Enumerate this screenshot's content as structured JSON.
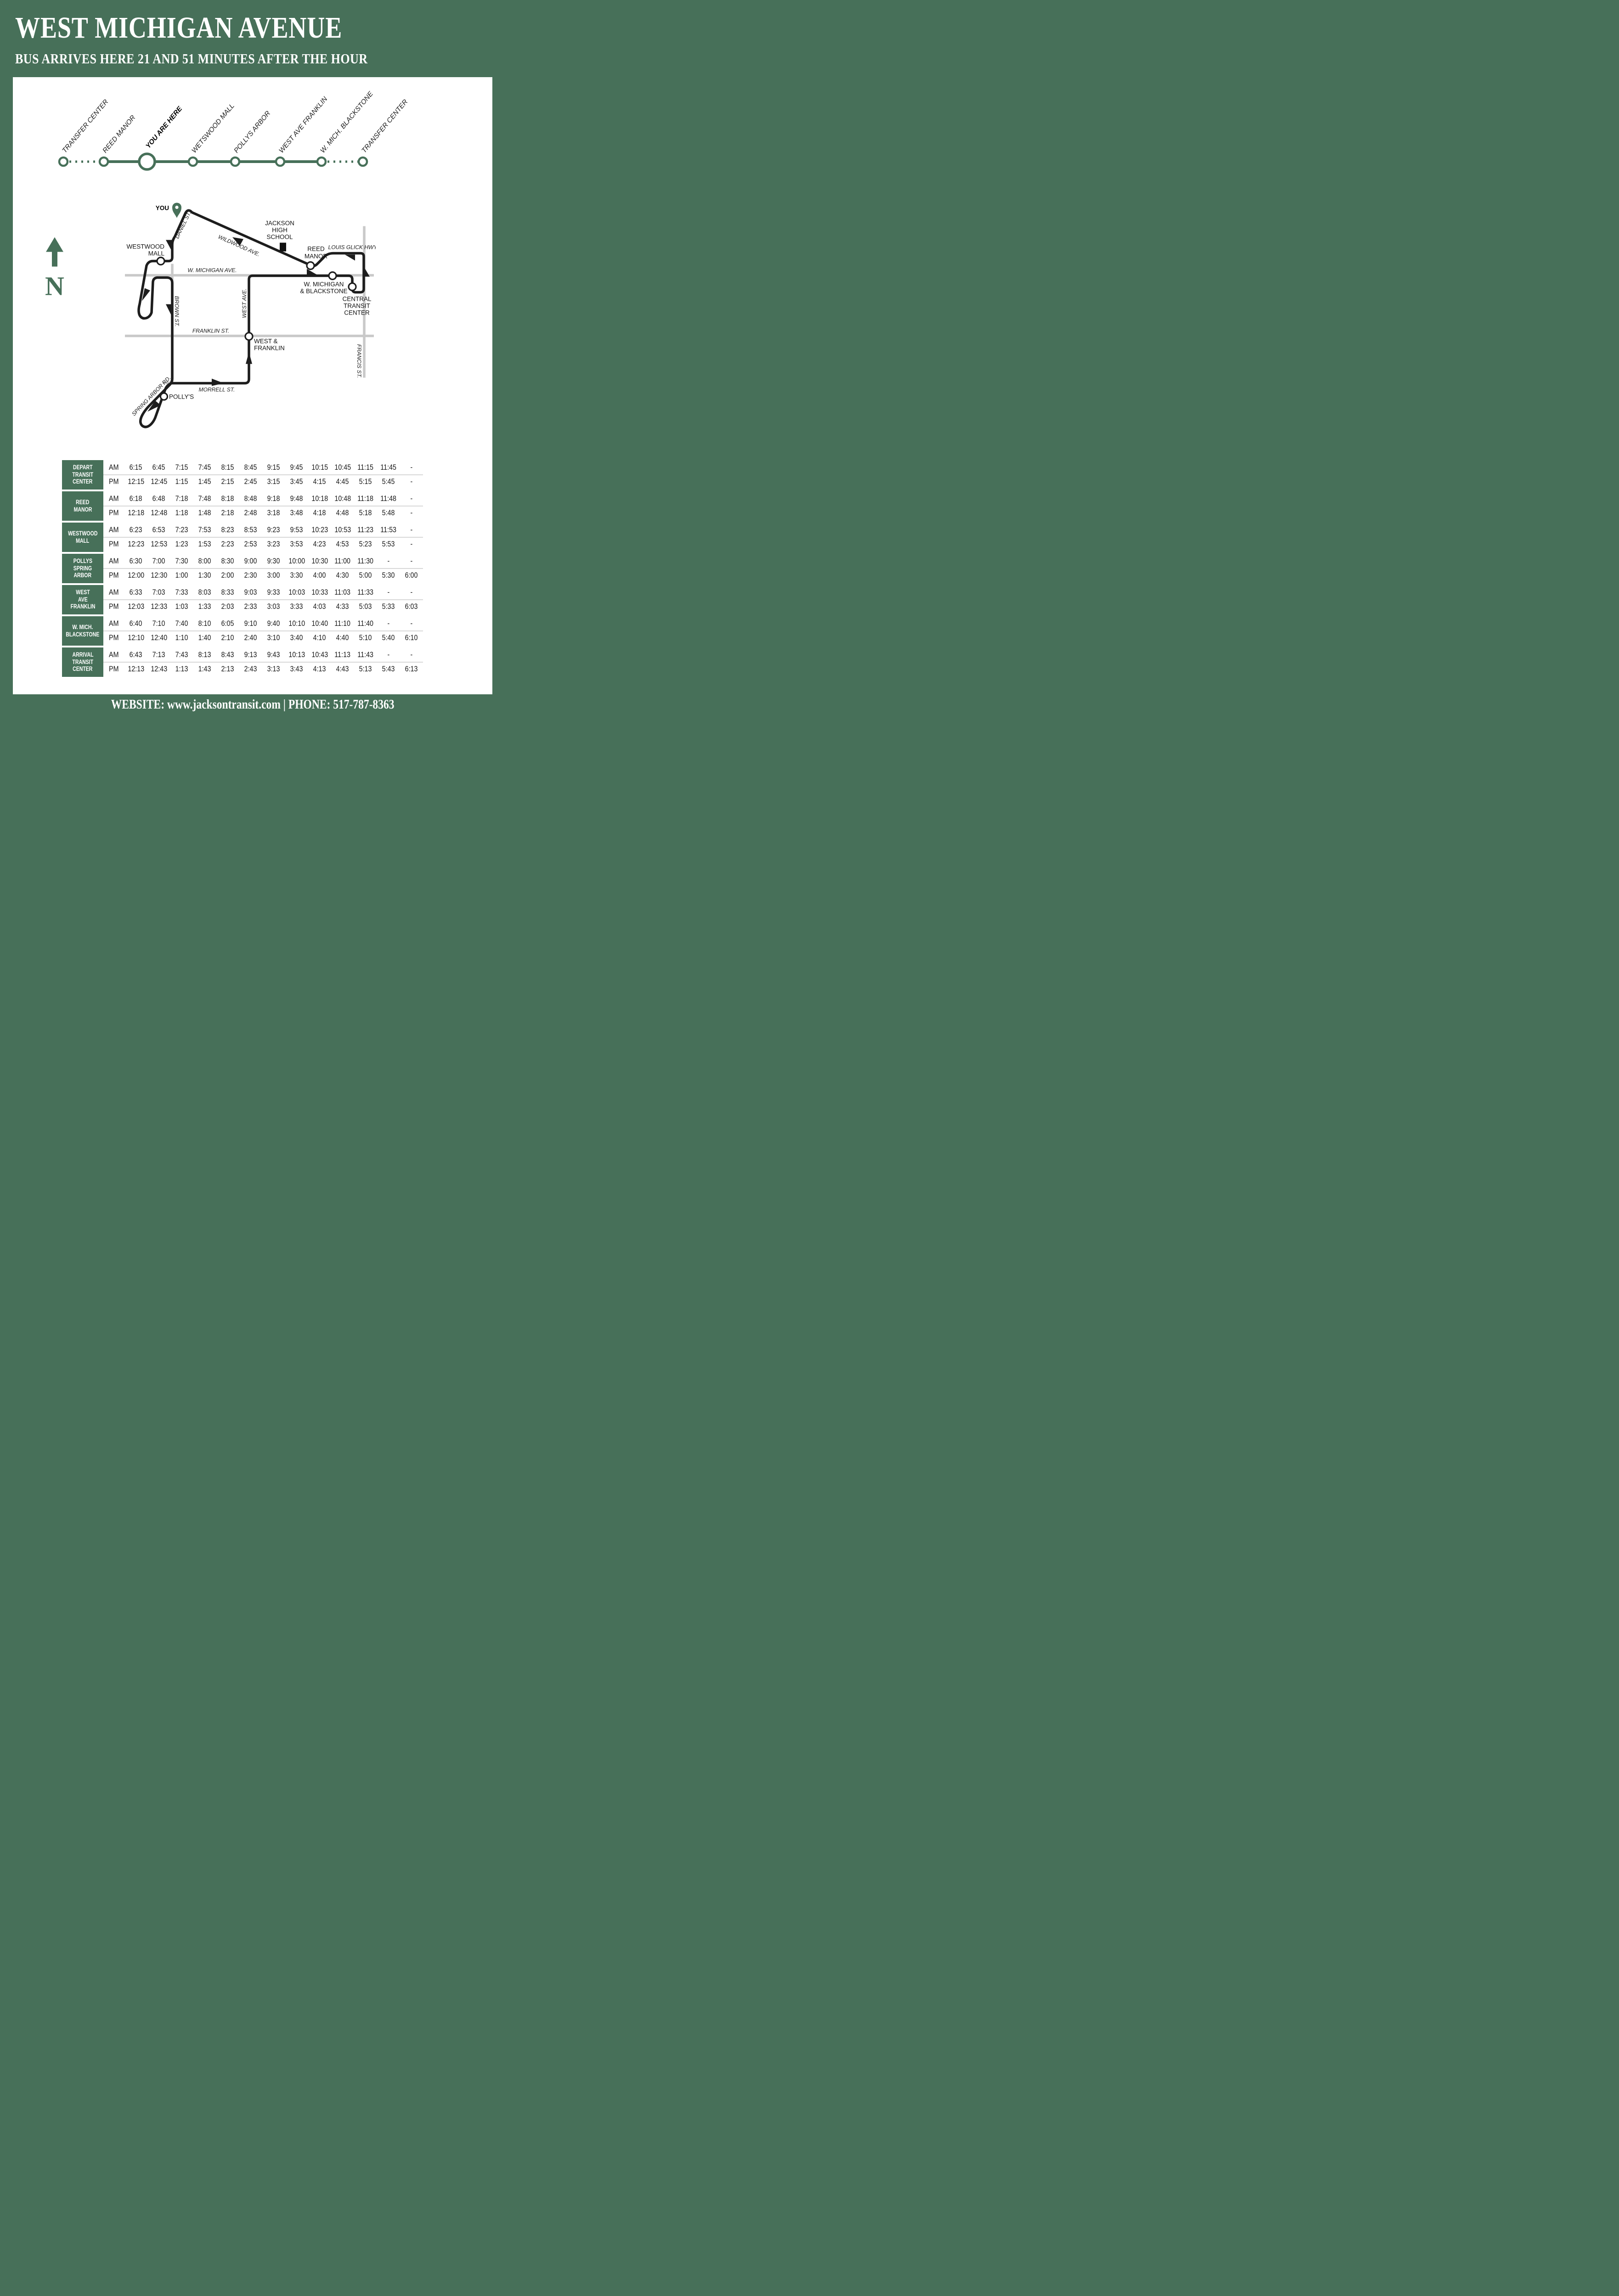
{
  "colors": {
    "green": "#477059",
    "route_black": "#1d1d1d",
    "street_gray": "#c9c9c9"
  },
  "header": {
    "title": "WEST MICHIGAN AVENUE",
    "subtitle": "BUS ARRIVES HERE 21 AND 51 MINUTES AFTER THE HOUR"
  },
  "line_diagram": {
    "stops": [
      {
        "label": "TRANSFER CENTER",
        "emphasis": false
      },
      {
        "label": "REED MANOR",
        "emphasis": false
      },
      {
        "label": "YOU ARE HERE",
        "emphasis": true
      },
      {
        "label": "WETSWOOD MALL",
        "emphasis": false
      },
      {
        "label": "POLLYS ARBOR",
        "emphasis": false
      },
      {
        "label": "WEST AVE FRANKLIN",
        "emphasis": false
      },
      {
        "label": "W. MICH. BLACKSTONE",
        "emphasis": false
      },
      {
        "label": "TRANSFER CENTER",
        "emphasis": false
      }
    ],
    "dotted_segments": [
      0,
      6
    ]
  },
  "compass": {
    "label": "N"
  },
  "map": {
    "labels": {
      "you": "YOU",
      "jackson1": "JACKSON",
      "jackson2": "HIGH",
      "jackson3": "SCHOOL",
      "westwood1": "WESTWOOD",
      "westwood2": "MALL",
      "reed1": "REED",
      "reed2": "MANOR",
      "louis_glick": "LOUIS GLICK HWY.",
      "w_michigan_ave": "W. MICHIGAN AVE.",
      "blackstone1": "W. MICHIGAN",
      "blackstone2": "& BLACKSTONE",
      "ctc1": "CENTRAL",
      "ctc2": "TRANSIT",
      "ctc3": "CENTER",
      "wf1": "WEST &",
      "wf2": "FRANKLIN",
      "pollys": "POLLY'S",
      "daniel": "DANIEL ST.",
      "wildwood": "WILDWOOD AVE.",
      "brown": "BROWN ST.",
      "west_ave": "WEST AVE.",
      "franklin": "FRANKLIN ST.",
      "morrell": "MORRELL ST.",
      "spring_arbor": "SPRING ARBOR RD.",
      "francis": "FRANCIS ST."
    }
  },
  "timetable": {
    "period_labels": [
      "AM",
      "PM"
    ],
    "rows": [
      {
        "label_lines": [
          "DEPART",
          "TRANSIT",
          "CENTER"
        ],
        "am": [
          "6:15",
          "6:45",
          "7:15",
          "7:45",
          "8:15",
          "8:45",
          "9:15",
          "9:45",
          "10:15",
          "10:45",
          "11:15",
          "11:45",
          "-"
        ],
        "pm": [
          "12:15",
          "12:45",
          "1:15",
          "1:45",
          "2:15",
          "2:45",
          "3:15",
          "3:45",
          "4:15",
          "4:45",
          "5:15",
          "5:45",
          "-"
        ]
      },
      {
        "label_lines": [
          "REED",
          "MANOR"
        ],
        "am": [
          "6:18",
          "6:48",
          "7:18",
          "7:48",
          "8:18",
          "8:48",
          "9:18",
          "9:48",
          "10:18",
          "10:48",
          "11:18",
          "11:48",
          "-"
        ],
        "pm": [
          "12:18",
          "12:48",
          "1:18",
          "1:48",
          "2:18",
          "2:48",
          "3:18",
          "3:48",
          "4:18",
          "4:48",
          "5:18",
          "5:48",
          "-"
        ]
      },
      {
        "label_lines": [
          "WESTWOOD",
          "MALL"
        ],
        "am": [
          "6:23",
          "6:53",
          "7:23",
          "7:53",
          "8:23",
          "8:53",
          "9:23",
          "9:53",
          "10:23",
          "10:53",
          "11:23",
          "11:53",
          "-"
        ],
        "pm": [
          "12:23",
          "12:53",
          "1:23",
          "1:53",
          "2:23",
          "2:53",
          "3:23",
          "3:53",
          "4:23",
          "4:53",
          "5:23",
          "5:53",
          "-"
        ]
      },
      {
        "label_lines": [
          "POLLYS",
          "SPRING",
          "ARBOR"
        ],
        "am": [
          "6:30",
          "7:00",
          "7:30",
          "8:00",
          "8:30",
          "9:00",
          "9:30",
          "10:00",
          "10:30",
          "11:00",
          "11:30",
          "-",
          "-"
        ],
        "pm": [
          "12:00",
          "12:30",
          "1:00",
          "1:30",
          "2:00",
          "2:30",
          "3:00",
          "3:30",
          "4:00",
          "4:30",
          "5:00",
          "5:30",
          "6:00"
        ]
      },
      {
        "label_lines": [
          "WEST",
          "AVE",
          "FRANKLIN"
        ],
        "am": [
          "6:33",
          "7:03",
          "7:33",
          "8:03",
          "8:33",
          "9:03",
          "9:33",
          "10:03",
          "10:33",
          "11:03",
          "11:33",
          "-",
          "-"
        ],
        "pm": [
          "12:03",
          "12:33",
          "1:03",
          "1:33",
          "2:03",
          "2:33",
          "3:03",
          "3:33",
          "4:03",
          "4:33",
          "5:03",
          "5:33",
          "6:03"
        ]
      },
      {
        "label_lines": [
          "W. MICH.",
          "BLACKSTONE"
        ],
        "am": [
          "6:40",
          "7:10",
          "7:40",
          "8:10",
          "6:05",
          "9:10",
          "9:40",
          "10:10",
          "10:40",
          "11:10",
          "11:40",
          "-",
          "-"
        ],
        "pm": [
          "12:10",
          "12:40",
          "1:10",
          "1:40",
          "2:10",
          "2:40",
          "3:10",
          "3:40",
          "4:10",
          "4:40",
          "5:10",
          "5:40",
          "6:10"
        ]
      },
      {
        "label_lines": [
          "ARRIVAL",
          "TRANSIT",
          "CENTER"
        ],
        "am": [
          "6:43",
          "7:13",
          "7:43",
          "8:13",
          "8:43",
          "9:13",
          "9:43",
          "10:13",
          "10:43",
          "11:13",
          "11:43",
          "-",
          "-"
        ],
        "pm": [
          "12:13",
          "12:43",
          "1:13",
          "1:43",
          "2:13",
          "2:43",
          "3:13",
          "3:43",
          "4:13",
          "4:43",
          "5:13",
          "5:43",
          "6:13"
        ]
      }
    ]
  },
  "footer": {
    "website_label": "WEBSITE:",
    "website": "www.jacksontransit.com",
    "separator": "|",
    "phone_label": "PHONE:",
    "phone": "517-787-8363"
  }
}
